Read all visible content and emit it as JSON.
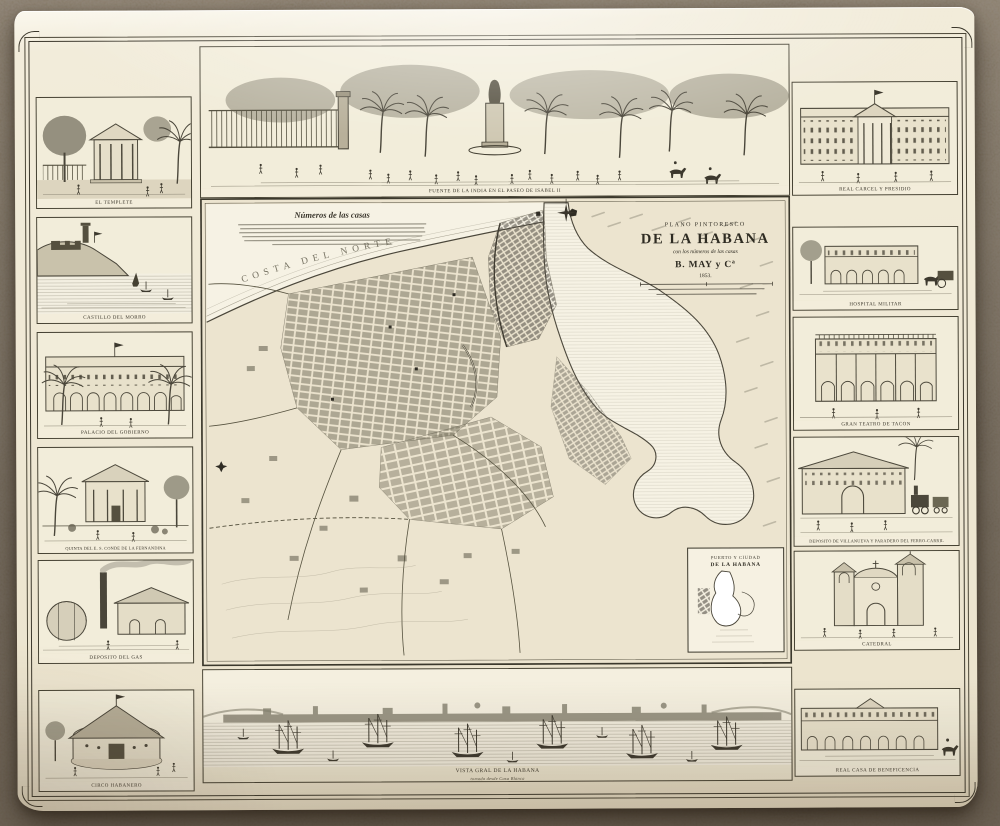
{
  "sheet": {
    "cartouche": {
      "lines": [
        "PLANO PINTORESCO",
        "DE LA HABANA",
        "con los números de las casas",
        "B. MAY y Cª",
        "1853."
      ]
    },
    "map": {
      "notes_heading": "Números de las casas",
      "coast_label": "COSTA DEL NORTE",
      "inset": {
        "line1": "PUERTO Y CIUDAD",
        "line2": "DE LA HABANA"
      }
    },
    "vignettes": {
      "top": {
        "caption": "FUENTE DE LA INDIA EN EL PASEO DE ISABEL II"
      },
      "left": [
        {
          "caption": "EL TEMPLETE"
        },
        {
          "caption": "CASTILLO DEL MORRO"
        },
        {
          "caption": "PALACIO DEL GOBIERNO"
        },
        {
          "caption": "QUINTA DEL E. S. CONDE DE LA FERNANDINA"
        },
        {
          "caption": "DEPOSITO DEL GAS"
        }
      ],
      "right": [
        {
          "caption": "REAL CARCEL Y PRESIDIO"
        },
        {
          "caption": "HOSPITAL MILITAR"
        },
        {
          "caption": "GRAN TEATRO DE TACON"
        },
        {
          "caption": "DEPOSITO DE VILLANUEVA Y PARADERO DEL FERRO-CARRIL"
        },
        {
          "caption": "CATEDRAL"
        }
      ],
      "bottom_left": {
        "caption": "CIRCO HABANERO"
      },
      "bottom_center": {
        "caption": "VISTA GRAL DE LA HABANA",
        "subcaption": "tomada desde Casa Blanca"
      },
      "bottom_right": {
        "caption": "REAL CASA DE BENEFICENCIA"
      }
    },
    "colors": {
      "paper": "#f0e9d6",
      "ink": "#3a372c",
      "carpet": "#93856f"
    }
  }
}
